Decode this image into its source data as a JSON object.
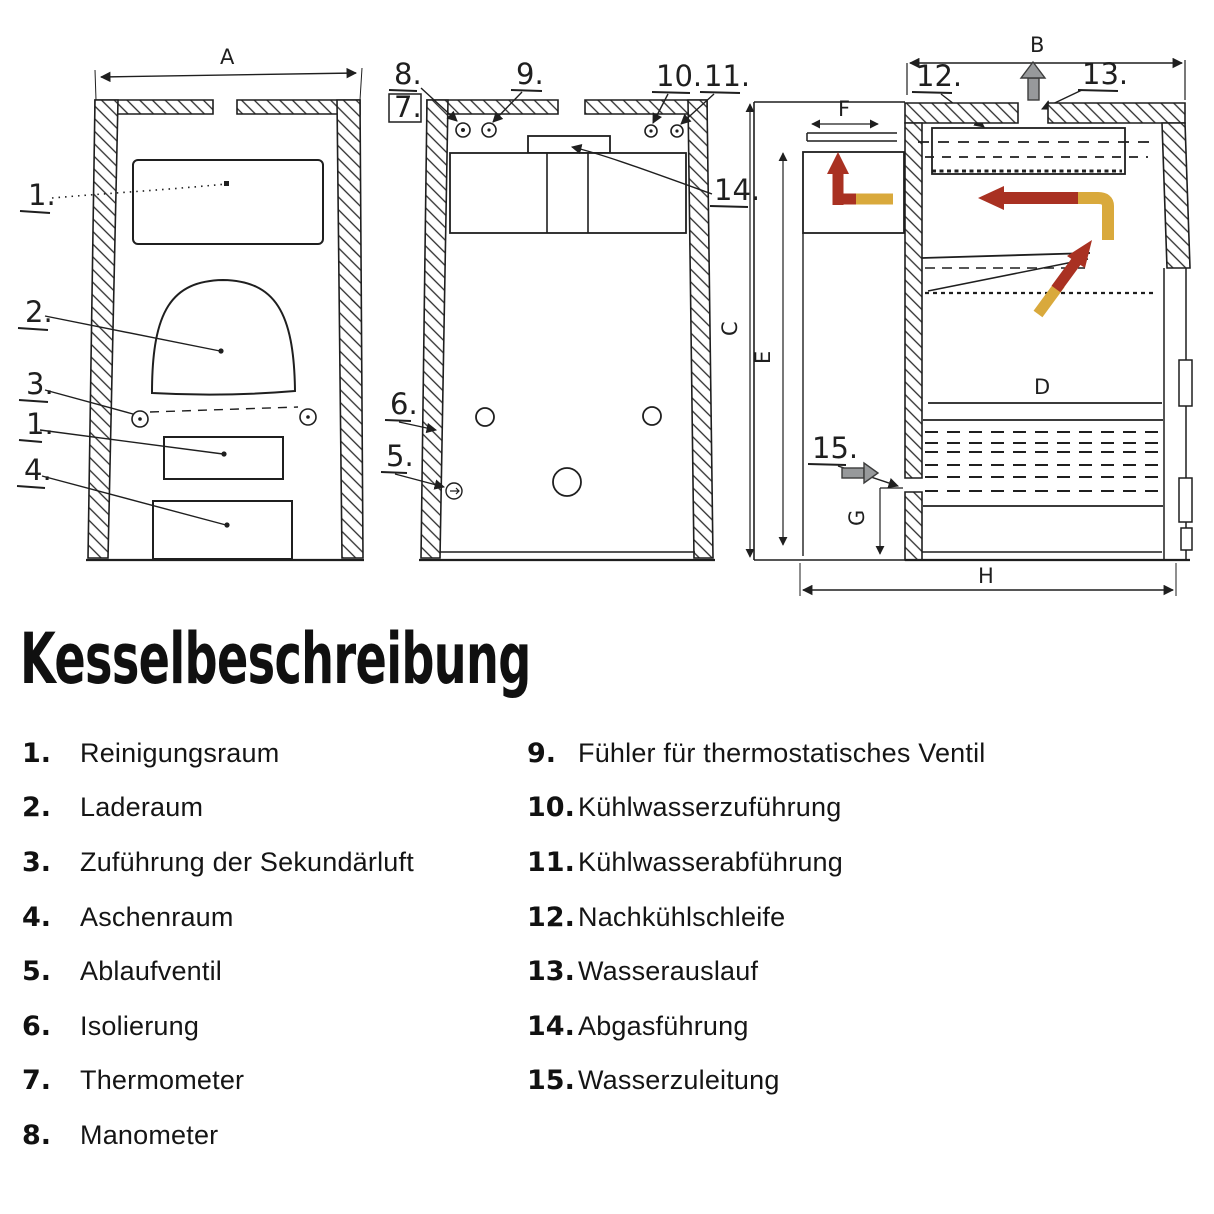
{
  "title": "Kesselbeschreibung",
  "legend": {
    "left": [
      {
        "num": "1.",
        "label": "Reinigungsraum"
      },
      {
        "num": "2.",
        "label": "Laderaum"
      },
      {
        "num": "3.",
        "label": "Zuführung der Sekundärluft"
      },
      {
        "num": "4.",
        "label": "Aschenraum"
      },
      {
        "num": "5.",
        "label": "Ablaufventil"
      },
      {
        "num": "6.",
        "label": "Isolierung"
      },
      {
        "num": "7.",
        "label": "Thermometer"
      },
      {
        "num": "8.",
        "label": "Manometer"
      }
    ],
    "right": [
      {
        "num": "9.",
        "label": "Fühler für thermostatisches Ventil"
      },
      {
        "num": "10.",
        "label": "Kühlwasserzuführung"
      },
      {
        "num": "11.",
        "label": "Kühlwasserabführung"
      },
      {
        "num": "12.",
        "label": "Nachkühlschleife"
      },
      {
        "num": "13.",
        "label": "Wasserauslauf"
      },
      {
        "num": "14.",
        "label": "Abgasführung"
      },
      {
        "num": "15.",
        "label": "Wasserzuleitung"
      }
    ]
  },
  "callouts": {
    "c1": "1.",
    "c2": "2.",
    "c3": "3.",
    "c1b": "1.",
    "c4": "4.",
    "c5": "5.",
    "c6": "6.",
    "c7": "7.",
    "c8": "8.",
    "c9": "9.",
    "c10": "10.",
    "c11": "11.",
    "c12": "12.",
    "c13": "13.",
    "c14": "14.",
    "c15": "15."
  },
  "dims": {
    "a": "A",
    "b": "B",
    "c": "C",
    "d": "D",
    "e": "E",
    "f": "F",
    "g": "G",
    "h": "H"
  },
  "colors": {
    "ink": "#1f1f1f",
    "flue_red": "#a93122",
    "flue_yellow": "#d9a93c",
    "water_gray": "#97999b"
  }
}
